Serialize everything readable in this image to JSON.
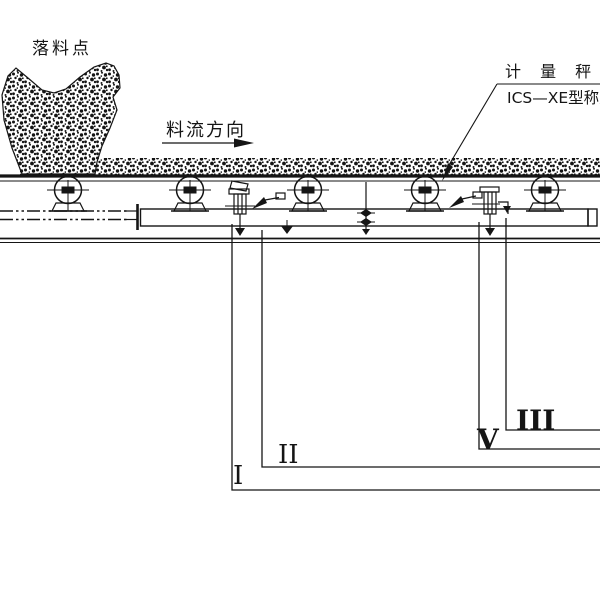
{
  "drawing": {
    "labels": {
      "drop_point": "落料点",
      "flow_direction": "料流方向",
      "meter_title": "计 量 秤",
      "meter_model": "ICS—XE型称重",
      "section_I": "I",
      "section_II": "II",
      "section_III": "III",
      "section_V": "V"
    },
    "colors": {
      "ink": "#151515",
      "paper": "#ffffff"
    },
    "idler_count": 5
  }
}
